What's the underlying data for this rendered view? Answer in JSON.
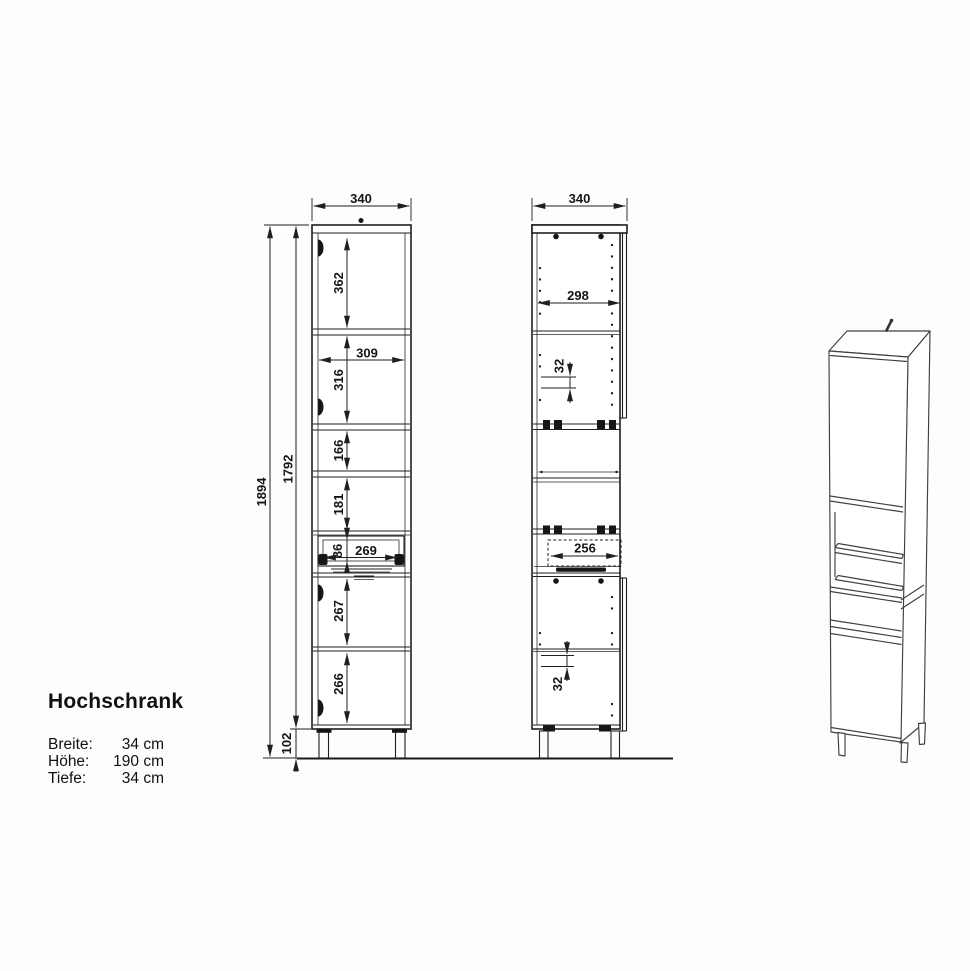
{
  "product": {
    "name": "Hochschrank",
    "specs": [
      {
        "label": "Breite:",
        "value": "34 cm"
      },
      {
        "label": "Höhe:",
        "value": "190 cm"
      },
      {
        "label": "Tiefe:",
        "value": "34 cm"
      }
    ]
  },
  "front_view": {
    "width": "340",
    "total_height": "1894",
    "carcass_height": "1792",
    "compartment_1": "362",
    "shelf_width": "309",
    "compartment_2": "316",
    "compartment_3": "166",
    "compartment_4": "181",
    "drawer_height": "86",
    "drawer_width": "269",
    "compartment_5": "267",
    "compartment_6": "266",
    "plinth_height": "102"
  },
  "side_view": {
    "depth": "340",
    "interior_depth": "298",
    "hole_pitch_upper": "32",
    "drawer_depth": "256",
    "hole_pitch_lower": "32"
  },
  "colors": {
    "line": "#1f1f1f",
    "perspective_line": "#404040",
    "text": "#161616",
    "background": "#ffffff"
  }
}
